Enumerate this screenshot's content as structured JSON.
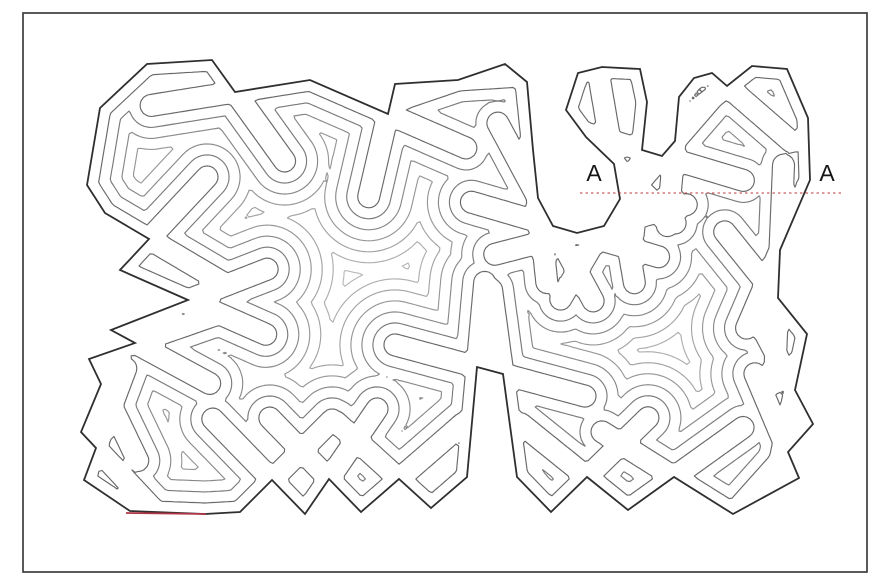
{
  "figure": {
    "background_color": "#ffffff",
    "frame": {
      "x": 23,
      "y": 13,
      "width": 844,
      "height": 559,
      "stroke": "#3d3d3d",
      "stroke_width": 1.7
    },
    "section_labels": {
      "left": {
        "text": "A",
        "x": 594,
        "y": 181
      },
      "right": {
        "text": "A",
        "x": 827,
        "y": 181
      },
      "font_size": 23,
      "color": "#161616"
    },
    "section_line": {
      "x1": 580,
      "y1": 193,
      "x2": 844,
      "y2": 193,
      "color": "#c23939",
      "width": 1.1,
      "dash": "2.5 3"
    },
    "red_mark": {
      "x1": 126,
      "y1": 513,
      "x2": 206,
      "y2": 514,
      "color": "#b03545",
      "width": 1.7
    },
    "contours": {
      "outline_color": "#2f2f2f",
      "outline_width": 1.8,
      "inner_width": 1.15,
      "interval_px": 11,
      "levels": 10,
      "level_colors": [
        "#686868",
        "#7a7a7a",
        "#898989",
        "#979797",
        "#a3a3a3",
        "#aeaeae",
        "#b8b8b8",
        "#c1c1c1",
        "#cacaca",
        "#d2d2d2"
      ],
      "miter_extension_px": 85,
      "grid_cell_px": 3,
      "grid_origin": [
        78,
        50
      ],
      "grid_size": [
        744,
        476
      ],
      "outer_polygon": [
        [
          100,
          108
        ],
        [
          147,
          64
        ],
        [
          212,
          60
        ],
        [
          235,
          92
        ],
        [
          310,
          80
        ],
        [
          388,
          114
        ],
        [
          395,
          84
        ],
        [
          458,
          80
        ],
        [
          505,
          64
        ],
        [
          527,
          82
        ],
        [
          533,
          150
        ],
        [
          538,
          198
        ],
        [
          553,
          226
        ],
        [
          577,
          233
        ],
        [
          604,
          226
        ],
        [
          620,
          199
        ],
        [
          614,
          164
        ],
        [
          586,
          137
        ],
        [
          566,
          110
        ],
        [
          578,
          73
        ],
        [
          602,
          67
        ],
        [
          640,
          69
        ],
        [
          647,
          102
        ],
        [
          642,
          150
        ],
        [
          662,
          156
        ],
        [
          675,
          141
        ],
        [
          679,
          97
        ],
        [
          694,
          78
        ],
        [
          712,
          73
        ],
        [
          727,
          86
        ],
        [
          752,
          66
        ],
        [
          787,
          69
        ],
        [
          808,
          118
        ],
        [
          810,
          180
        ],
        [
          780,
          250
        ],
        [
          778,
          298
        ],
        [
          807,
          334
        ],
        [
          795,
          390
        ],
        [
          813,
          424
        ],
        [
          788,
          452
        ],
        [
          799,
          478
        ],
        [
          733,
          514
        ],
        [
          674,
          477
        ],
        [
          628,
          510
        ],
        [
          587,
          477
        ],
        [
          551,
          512
        ],
        [
          517,
          477
        ],
        [
          503,
          374
        ],
        [
          477,
          367
        ],
        [
          467,
          477
        ],
        [
          431,
          508
        ],
        [
          399,
          479
        ],
        [
          361,
          512
        ],
        [
          329,
          479
        ],
        [
          305,
          514
        ],
        [
          272,
          480
        ],
        [
          240,
          512
        ],
        [
          205,
          514
        ],
        [
          130,
          511
        ],
        [
          84,
          480
        ],
        [
          96,
          448
        ],
        [
          81,
          432
        ],
        [
          101,
          384
        ],
        [
          89,
          359
        ],
        [
          135,
          343
        ],
        [
          111,
          330
        ],
        [
          188,
          300
        ],
        [
          120,
          270
        ],
        [
          149,
          239
        ],
        [
          105,
          213
        ],
        [
          87,
          185
        ]
      ]
    }
  }
}
